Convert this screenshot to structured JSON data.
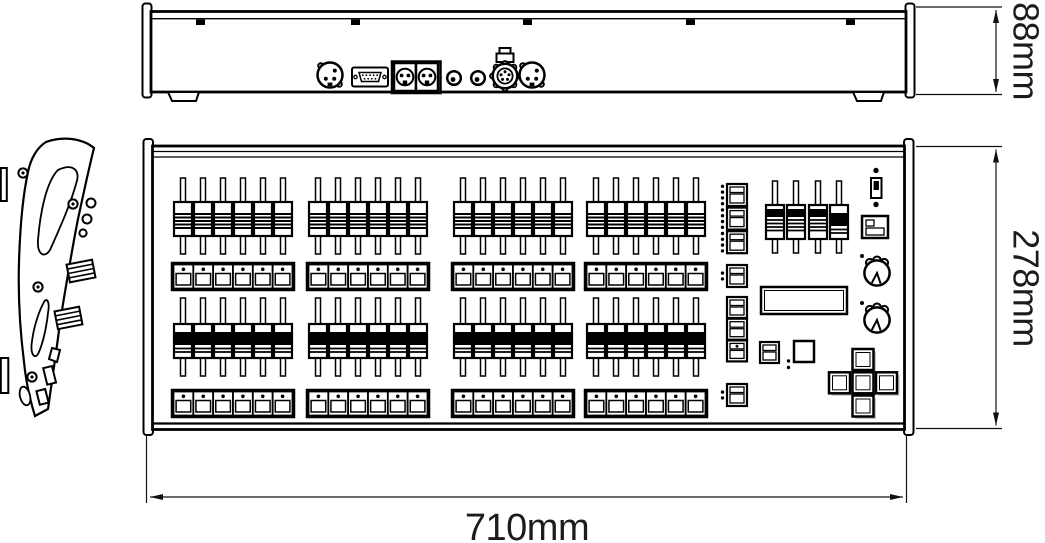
{
  "drawing": {
    "dim_height_rear": "88mm",
    "dim_depth_panel": "278mm",
    "dim_width": "710mm"
  },
  "colors": {
    "line": "#000000",
    "background": "#ffffff",
    "dim_text": "#1c1c1c",
    "button_shadow": "#c4c4c4"
  },
  "layout_counts": {
    "fader_group_rows": 2,
    "fader_group_cols": 4,
    "faders_per_group": 6,
    "bump_buttons_per_group": 6,
    "master_faders": 4,
    "page_buttons_with_4_leds": 3,
    "mid_function_buttons": 3,
    "rotary_knobs": 2,
    "arrow_pad_buttons": 5
  },
  "rear_panel": {
    "connectors": [
      {
        "name": "xlr-3pin-connector-a",
        "type": "xlr"
      },
      {
        "name": "db9-serial-connector",
        "type": "db9"
      },
      {
        "name": "din-connector-a",
        "type": "din"
      },
      {
        "name": "din-connector-b",
        "type": "din"
      },
      {
        "name": "small-jack-a",
        "type": "jack"
      },
      {
        "name": "small-jack-b",
        "type": "jack"
      },
      {
        "name": "xlr-5pin-latched-connector",
        "type": "xlr_latch"
      },
      {
        "name": "xlr-3pin-connector-b",
        "type": "xlr"
      }
    ]
  }
}
